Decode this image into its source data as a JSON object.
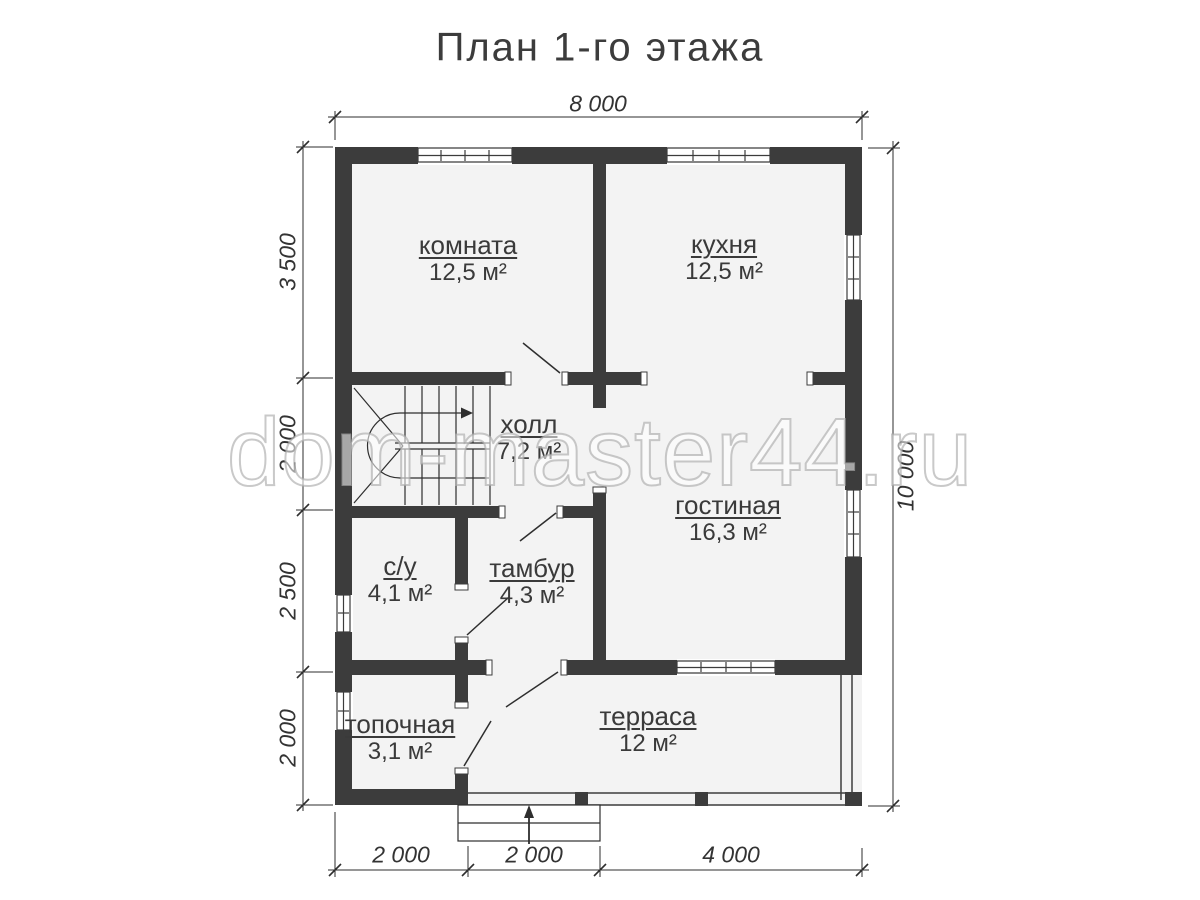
{
  "title": "План 1-го этажа",
  "watermark": "dom-master44.ru",
  "rooms": {
    "komnata": {
      "name": "комната",
      "area": "12,5 м²"
    },
    "kuhnya": {
      "name": "кухня",
      "area": "12,5 м²"
    },
    "holl": {
      "name": "холл",
      "area": "7,2 м²"
    },
    "gostinaya": {
      "name": "гостиная",
      "area": "16,3 м²"
    },
    "su": {
      "name": "с/у",
      "area": "4,1 м²"
    },
    "tambur": {
      "name": "тамбур",
      "area": "4,3 м²"
    },
    "topochnaya": {
      "name": "топочная",
      "area": "3,1 м²"
    },
    "terrasa": {
      "name": "терраса",
      "area": "12 м²"
    }
  },
  "dimensions": {
    "top": "8 000",
    "right": "10 000",
    "left": [
      "3 500",
      "2 000",
      "2 500",
      "2 000"
    ],
    "bottom": [
      "2 000",
      "2 000",
      "4 000"
    ]
  },
  "colors": {
    "wall": "#3c3c3c",
    "line": "#2e2e2e",
    "floor": "#f3f3f3",
    "watermark_outline": "#acacac"
  }
}
